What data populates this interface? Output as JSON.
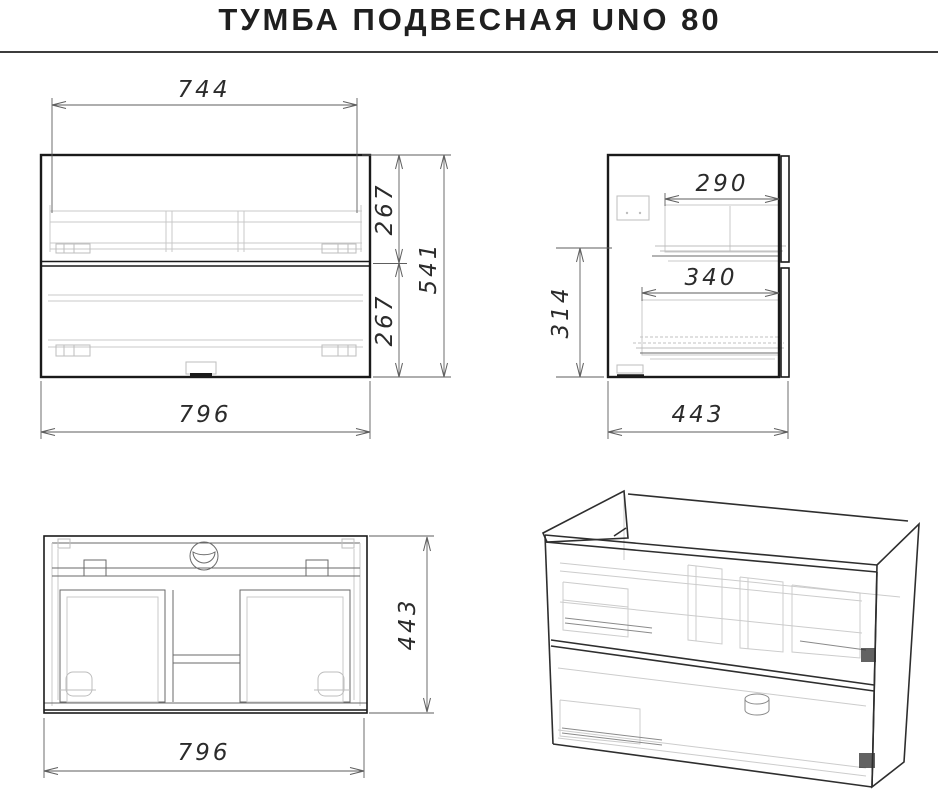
{
  "title": "ТУМБА ПОДВЕСНАЯ UNO 80",
  "product": {
    "type": "wall-hung vanity cabinet drawing",
    "views": [
      "front",
      "side",
      "top",
      "isometric-wireframe"
    ]
  },
  "dimensions": {
    "front": {
      "inner_width": "744",
      "upper_drawer_height": "267",
      "lower_drawer_height": "267",
      "total_height": "541",
      "overall_width": "796"
    },
    "side": {
      "upper_drawer_depth": "290",
      "lower_drawer_depth": "340",
      "lower_section_height": "314",
      "overall_depth": "443"
    },
    "top": {
      "overall_depth": "443",
      "overall_width": "796"
    }
  },
  "colors": {
    "background": "#ffffff",
    "outline": "#1a1a1a",
    "dimension_lines": "#5e5e5e",
    "light_detail": "#c9c9c9",
    "title_text": "#1f1f1f"
  }
}
